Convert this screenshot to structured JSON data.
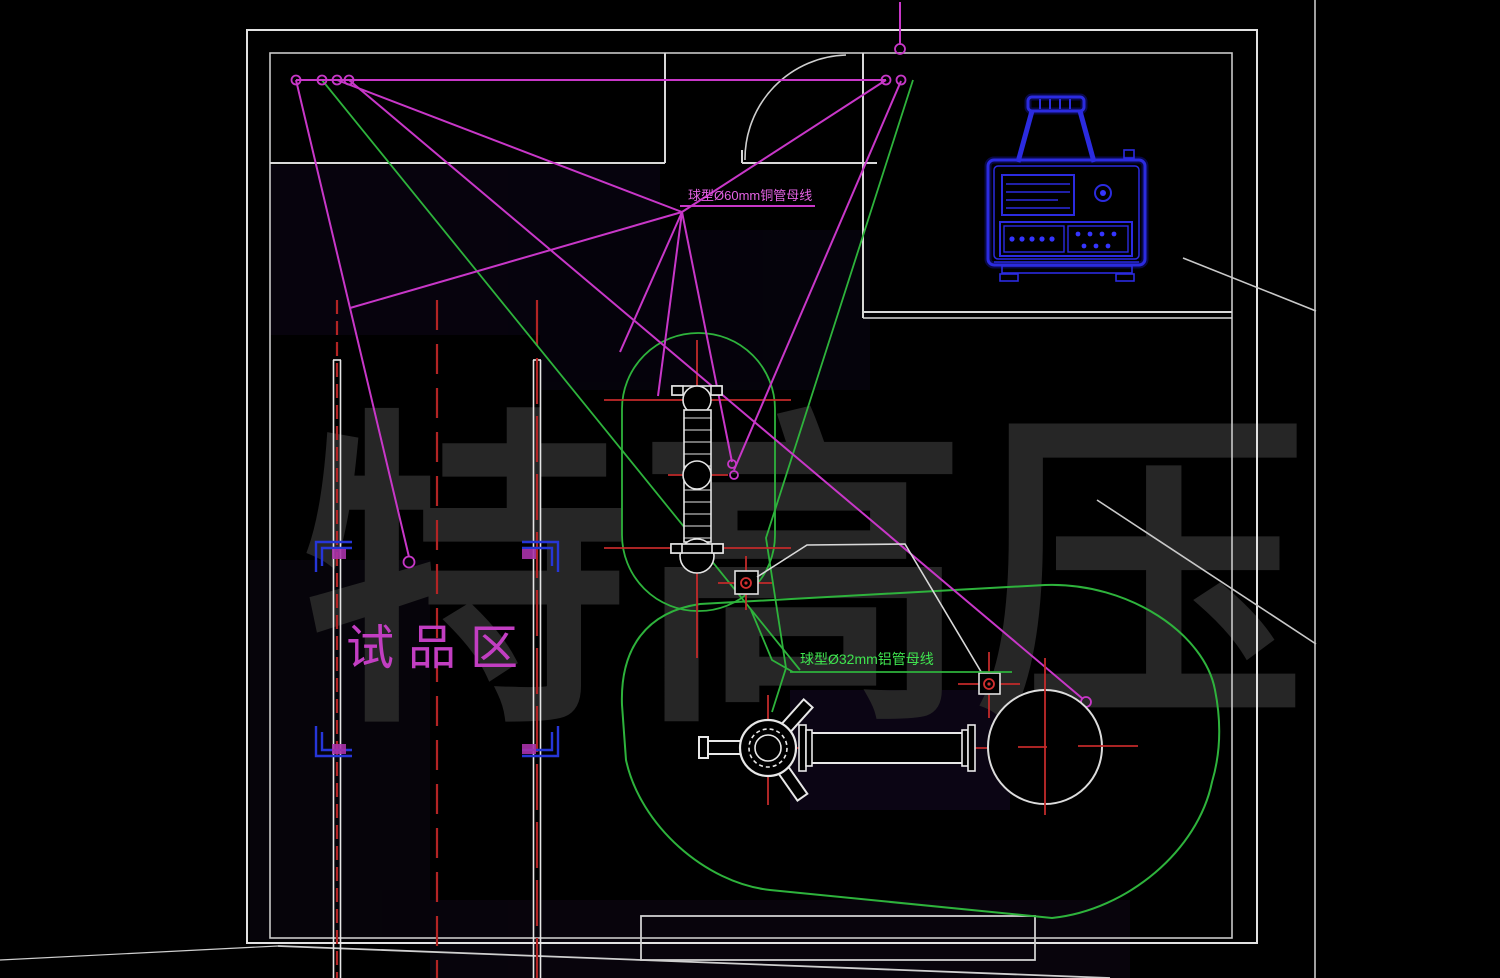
{
  "drawing": {
    "type": "cad-floor-plan",
    "description": "UHV high-voltage test hall layout, AutoCAD style on black background"
  },
  "watermark": {
    "text": "特高压",
    "color": "#262626"
  },
  "labels": {
    "specimen_area": {
      "text": "试品区",
      "color": "#c23ec2"
    },
    "busbar_magenta": {
      "text": "球型Ø60mm铜管母线",
      "color": "#e362e3"
    },
    "busbar_green": {
      "text": "球型Ø32mm铝管母线",
      "color": "#3fe44f"
    }
  },
  "equipment": {
    "control_console": {
      "name": "blue control console",
      "color": "#2525dd"
    }
  },
  "colors": {
    "wall": "#d9d9d9",
    "magenta_cable": "#c837c8",
    "green_busbar": "#2eb33c",
    "centerline_red": "#b32424",
    "blue": "#2525dd",
    "background": "#000000"
  }
}
